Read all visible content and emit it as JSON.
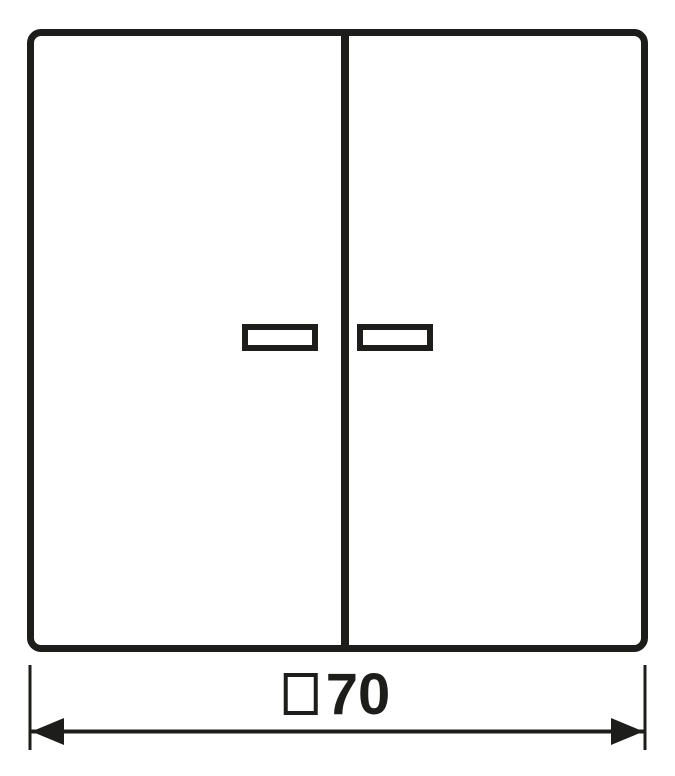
{
  "colors": {
    "line": "#1d1d1b",
    "background": "#ffffff"
  },
  "drawing": {
    "dimension": {
      "symbol_icon": "square-symbol",
      "value": "70"
    }
  }
}
